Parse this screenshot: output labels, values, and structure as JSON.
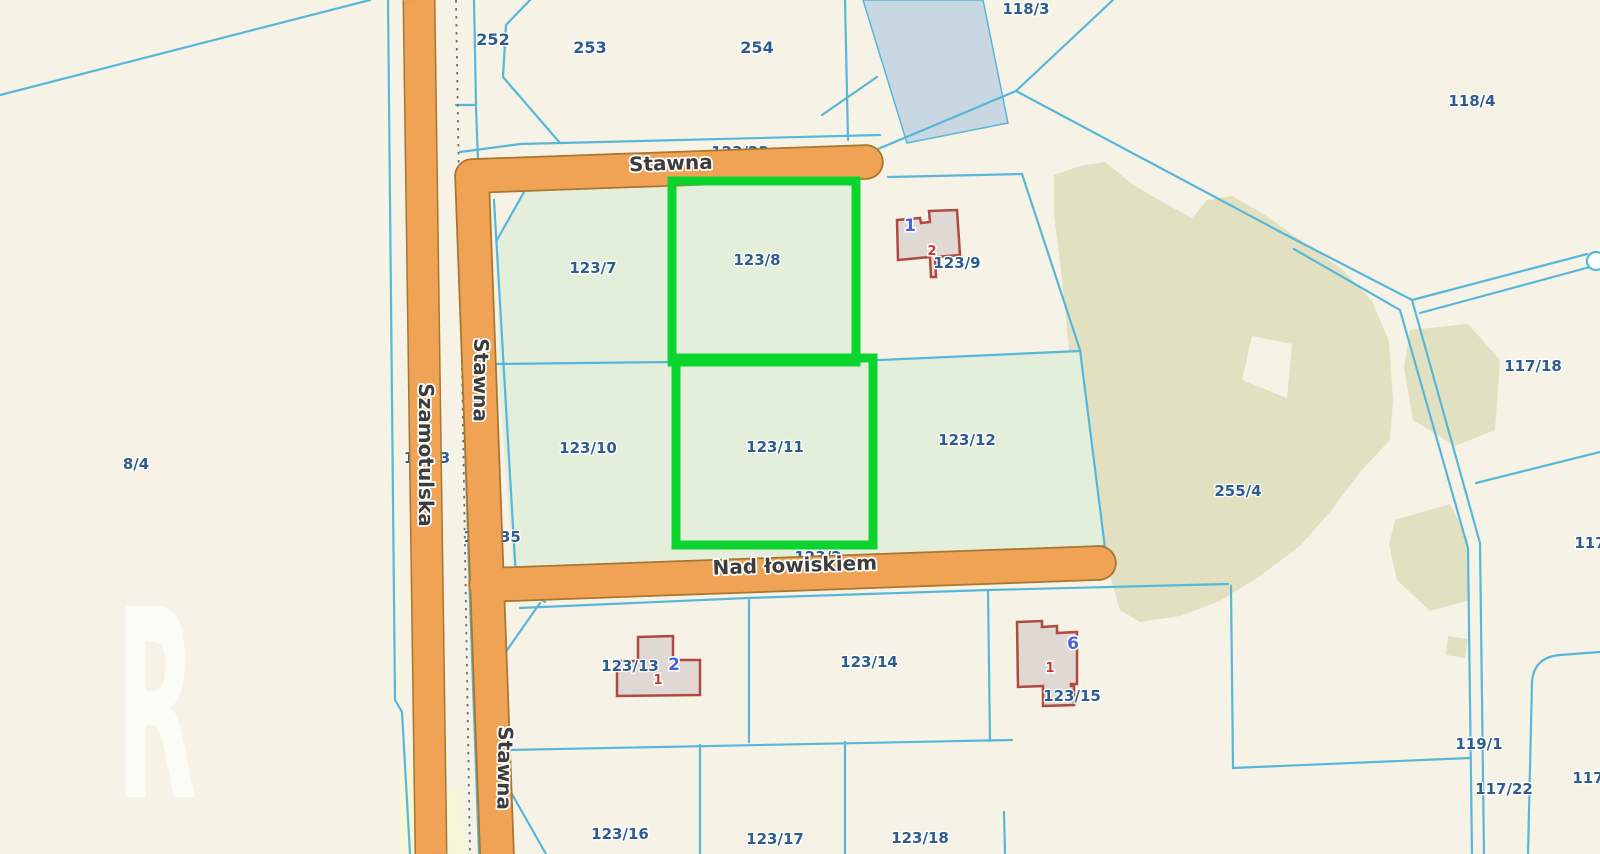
{
  "map": {
    "type": "cadastral-parcel-map",
    "roads": {
      "szamotulska": {
        "label": "Szamotulska"
      },
      "stawna_horizontal": {
        "label": "Stawna"
      },
      "stawna_vertical_upper": {
        "label": "Stawna"
      },
      "stawna_vertical_lower": {
        "label": "Stawna"
      },
      "nad_lowiskiem": {
        "label": "Nad łowiskiem"
      }
    },
    "highlighted_parcels": [
      "123/8",
      "123/11"
    ],
    "parcels": [
      {
        "text": "252"
      },
      {
        "text": "253"
      },
      {
        "text": "254"
      },
      {
        "text": "118/3"
      },
      {
        "text": "118/4"
      },
      {
        "text": "8/4"
      },
      {
        "text": "123/7"
      },
      {
        "text": "123/8"
      },
      {
        "text": "123/9"
      },
      {
        "text": "123/10"
      },
      {
        "text": "123/11"
      },
      {
        "text": "123/12"
      },
      {
        "text": "123/13"
      },
      {
        "text": "123/14"
      },
      {
        "text": "123/15"
      },
      {
        "text": "123/16"
      },
      {
        "text": "123/17"
      },
      {
        "text": "123/18"
      },
      {
        "text": "255/4"
      },
      {
        "text": "117/18"
      },
      {
        "text": "119/1"
      },
      {
        "text": "117/22"
      },
      {
        "text": "117/2"
      },
      {
        "text": "117/2"
      }
    ],
    "hidden_labels": [
      {
        "text": "123/23",
        "note": "road parcel number mostly covered by Stawna road"
      },
      {
        "text": "123/35",
        "note": "only /35 visible right of Stawna road"
      },
      {
        "text": "123/2",
        "note": "sliver visible above Nad łowiskiem road"
      },
      {
        "text": "1",
        "note": "fragment left of Szamotulska road"
      },
      {
        "text": "3",
        "note": "fragment right of Szamotulska road"
      }
    ],
    "buildings": [
      {
        "parcel": "123/9",
        "address_number": "1",
        "building_number": "2"
      },
      {
        "parcel": "123/13",
        "address_number": "2",
        "building_number": "1"
      },
      {
        "parcel": "123/15",
        "address_number": "6",
        "building_number": "1"
      }
    ],
    "watermark_letter": {
      "text": "R"
    },
    "colors": {
      "background_cream": "#F6F2E6",
      "parcel_green_fill": "#E4EFDB",
      "vegetation_olive": "#E1E1C2",
      "water_blue": "#C8D7E2",
      "boundary_cyan": "#56B7DA",
      "road_orange": "#F0A355",
      "road_outline": "#A8762E",
      "highlight_green": "#0CD42E",
      "parcel_label_blue": "#2E5C8F",
      "road_label_gray": "#3C3C3C",
      "building_fill": "#E0D8D2",
      "building_outline": "#B04A40",
      "address_number_blue": "#4862D8",
      "building_number_red": "#CC3333",
      "pale_yellow": "#F6F7D7"
    }
  }
}
